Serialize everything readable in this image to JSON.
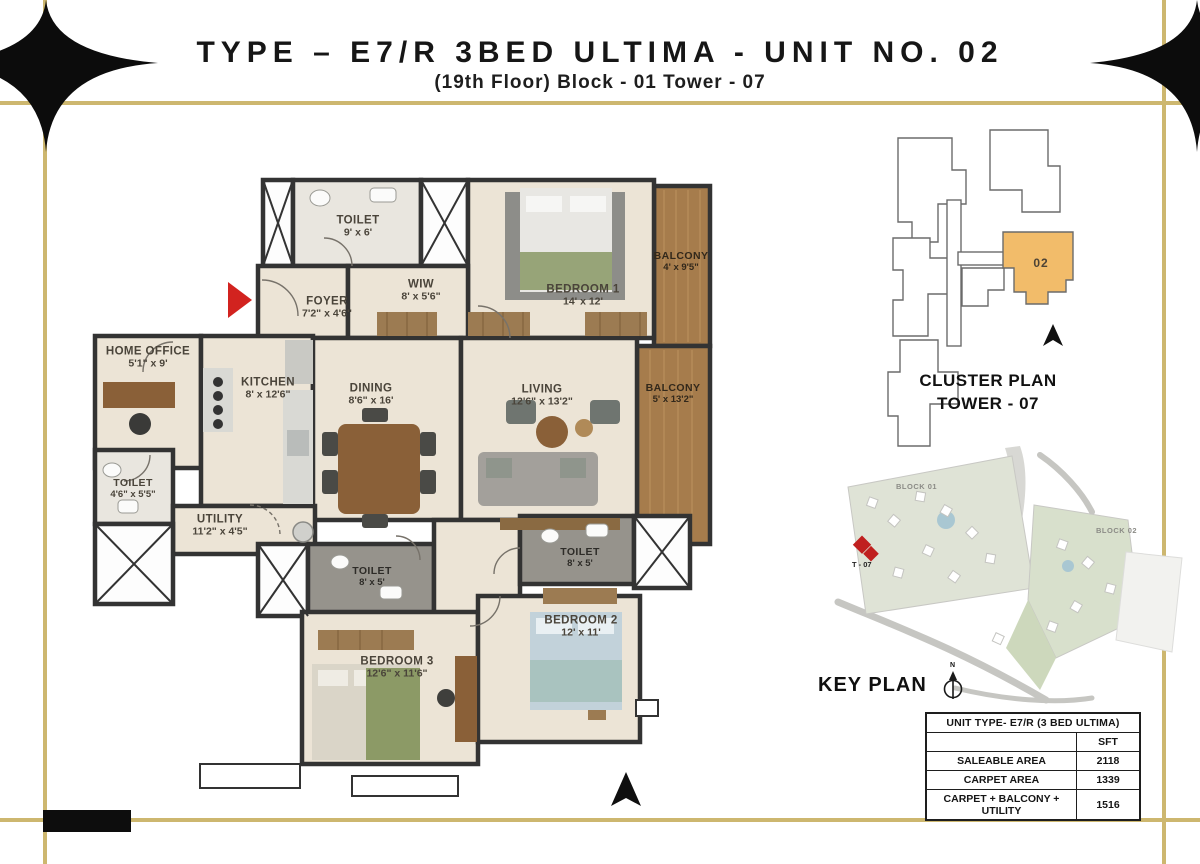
{
  "title": {
    "main": "TYPE – E7/R 3BED ULTIMA - UNIT NO. 02",
    "sub": "(19th Floor) Block - 01 Tower - 07"
  },
  "floorplan": {
    "rooms": [
      {
        "name": "TOILET",
        "dims": "9' x 6'"
      },
      {
        "name": "WIW",
        "dims": "8' x 5'6\""
      },
      {
        "name": "FOYER",
        "dims": "7'2\" x 4'6\""
      },
      {
        "name": "BEDROOM 1",
        "dims": "14' x 12'"
      },
      {
        "name": "BALCONY",
        "dims": "4' x 9'5\""
      },
      {
        "name": "HOME OFFICE",
        "dims": "5'1\" x 9'"
      },
      {
        "name": "KITCHEN",
        "dims": "8' x 12'6\""
      },
      {
        "name": "DINING",
        "dims": "8'6\" x 16'"
      },
      {
        "name": "LIVING",
        "dims": "12'6\" x 13'2\""
      },
      {
        "name": "BALCONY",
        "dims": "5' x 13'2\""
      },
      {
        "name": "TOILET",
        "dims": "4'6\" x 5'5\""
      },
      {
        "name": "UTILITY",
        "dims": "11'2\" x 4'5\""
      },
      {
        "name": "TOILET",
        "dims": "8' x 5'"
      },
      {
        "name": "TOILET",
        "dims": "8' x 5'"
      },
      {
        "name": "BEDROOM 3",
        "dims": "12'6\" x 11'6\""
      },
      {
        "name": "BEDROOM 2",
        "dims": "12' x 11'"
      }
    ]
  },
  "cluster": {
    "title_line1": "CLUSTER PLAN",
    "title_line2": "TOWER - 07",
    "unit_label": "02"
  },
  "keyplan": {
    "title": "KEY PLAN",
    "block1": "BLOCK 01",
    "block2": "BLOCK 02",
    "tower_label": "T - 07",
    "north_letter": "N"
  },
  "table": {
    "header": "UNIT TYPE- E7/R (3 BED ULTIMA)",
    "unit_column": "SFT",
    "rows": [
      {
        "label": "SALEABLE AREA",
        "value": "2118"
      },
      {
        "label": "CARPET AREA",
        "value": "1339"
      },
      {
        "label": "CARPET + BALCONY + UTILITY",
        "value": "1516"
      }
    ]
  },
  "colors": {
    "gold_border": "#cdb76f",
    "unit_orange": "#f2bc6a",
    "accent_red": "#d2231f",
    "wall": "#333333",
    "wood": "#a67c4c"
  }
}
